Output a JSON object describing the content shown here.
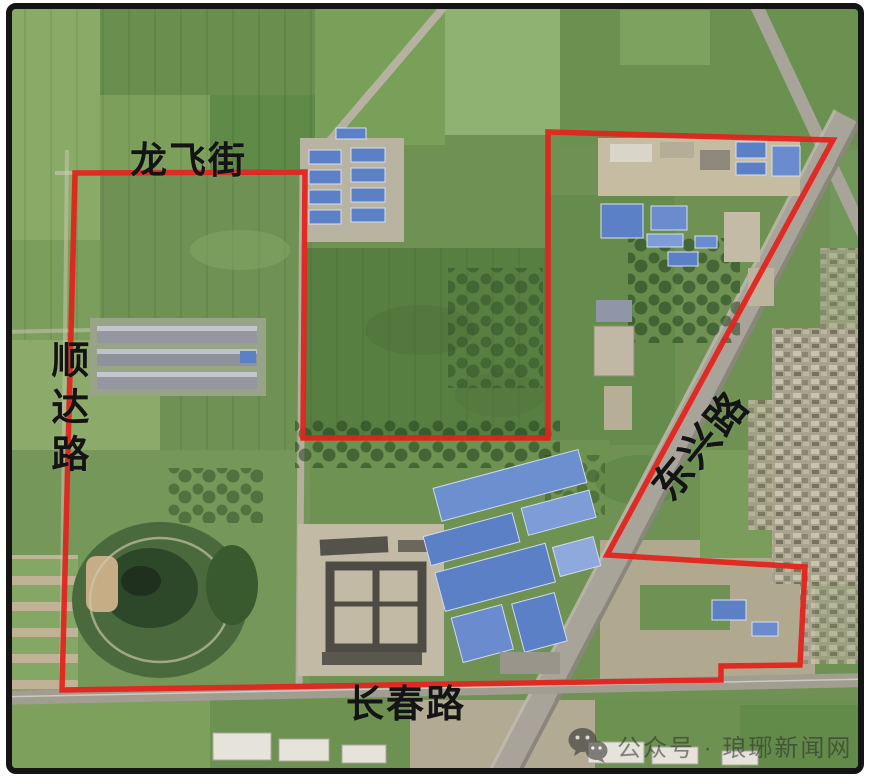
{
  "map": {
    "description": "satellite-imagery-with-red-planning-boundary",
    "boundary": {
      "color": "#e3211b",
      "points": [
        [
          75,
          173
        ],
        [
          305,
          172
        ],
        [
          303,
          438
        ],
        [
          548,
          438
        ],
        [
          548,
          132
        ],
        [
          833,
          140
        ],
        [
          607,
          555
        ],
        [
          805,
          567
        ],
        [
          800,
          665
        ],
        [
          721,
          666
        ],
        [
          721,
          680
        ],
        [
          62,
          690
        ]
      ]
    },
    "labels": [
      {
        "id": "longfei-street",
        "text": "龙飞街",
        "x": 130,
        "y": 142,
        "size": 37,
        "orientation": "horizontal",
        "rotation": 0
      },
      {
        "id": "shunda-road",
        "text": "顺达路",
        "x": 45,
        "y": 340,
        "size": 38,
        "orientation": "vertical",
        "rotation": 0
      },
      {
        "id": "dongxing-road",
        "text": "东兴路",
        "x": 701,
        "y": 446,
        "size": 40,
        "orientation": "horizontal",
        "rotation": -51,
        "anchor": "center"
      },
      {
        "id": "changchun-road",
        "text": "长春路",
        "x": 346,
        "y": 686,
        "size": 38,
        "orientation": "horizontal",
        "rotation": 0
      }
    ]
  },
  "watermark": {
    "icon": "wechat-icon",
    "text": "公众号 · 琅琊新闻网"
  },
  "colors": {
    "boundary": "#e3211b",
    "label_text": "#141414",
    "frame": "#141414",
    "page_bg": "#ffffff",
    "watermark_text": "rgba(45,45,45,0.58)"
  }
}
